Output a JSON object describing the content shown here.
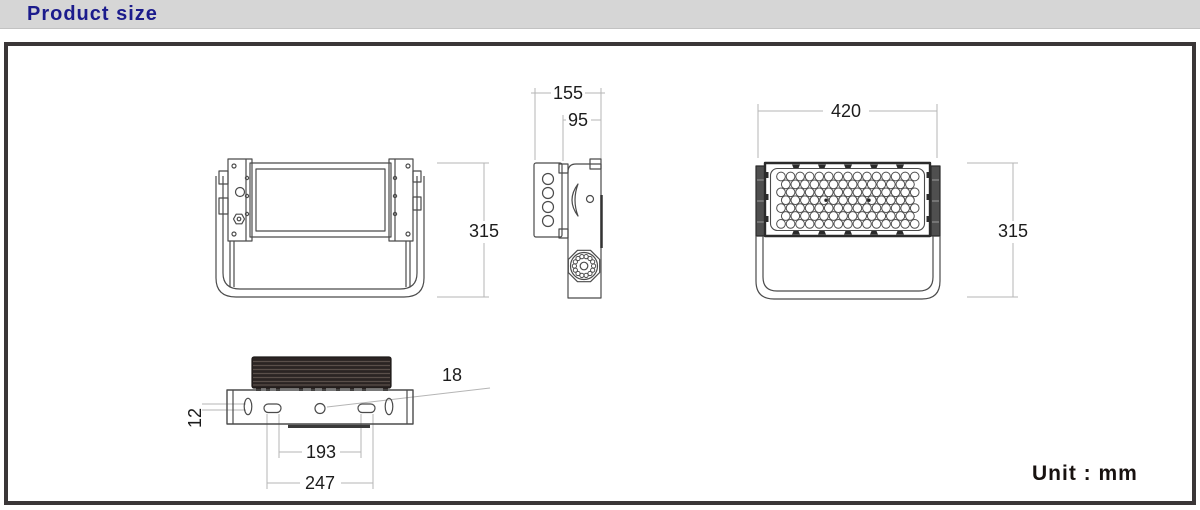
{
  "header": {
    "title": "Product size"
  },
  "footer": {
    "unit_label": "Unit : mm"
  },
  "colors": {
    "header_bg": "#d6d6d6",
    "title_navy": "#1b1b8c",
    "frame_border": "#3a3637",
    "drawing_line": "#4b4b4b",
    "dimension_line": "#b5b5b5",
    "dimension_text": "#1c1c1c",
    "heatsink_fill": "#2b2423"
  },
  "dims": {
    "back_height": "315",
    "side_total_depth": "155",
    "side_body_depth": "95",
    "front_width": "420",
    "front_height": "315",
    "bottom_slot_height": "12",
    "bottom_hole_dia": "18",
    "bottom_slot_span_inner": "193",
    "bottom_slot_span_outer": "247"
  }
}
